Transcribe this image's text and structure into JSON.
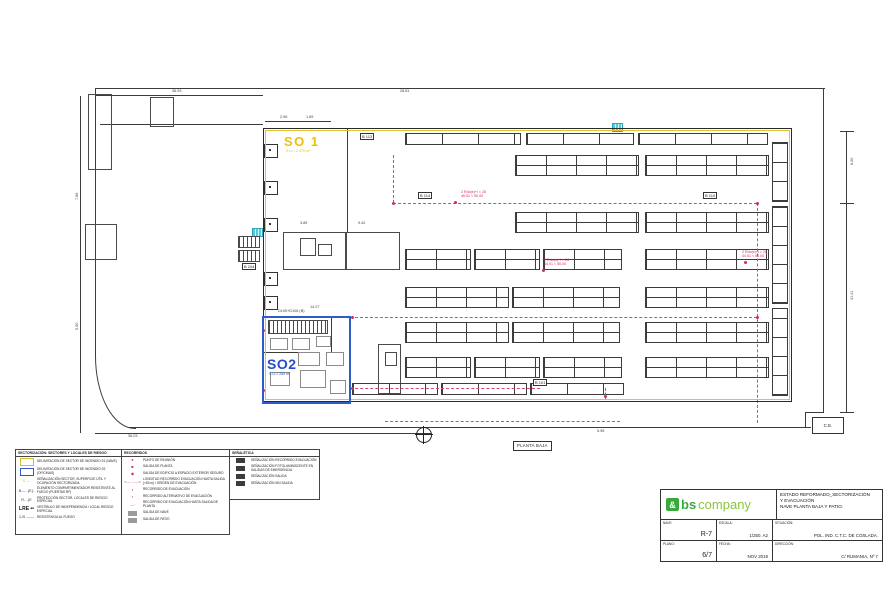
{
  "plan": {
    "sector1_label": "SO 1",
    "sector1_sub": "S.U.= 2.470 m²",
    "sector2_label": "SO2",
    "sector2_sub": "S.U.= 265 m²",
    "planta_label": "PLANTA BAJA",
    "ce_label": "C.E.",
    "walls": [
      [
        95,
        88,
        730,
        1
      ],
      [
        823,
        88,
        1,
        325
      ],
      [
        805,
        412,
        19,
        1
      ],
      [
        805,
        412,
        1,
        16
      ],
      [
        128,
        427,
        683,
        1
      ],
      [
        95,
        88,
        1,
        268
      ],
      [
        100,
        124,
        163,
        1
      ],
      [
        347,
        128,
        1,
        104
      ],
      [
        80,
        96,
        1,
        337
      ],
      [
        846,
        131,
        1,
        282
      ],
      [
        840,
        131,
        14,
        1
      ],
      [
        840,
        203,
        14,
        1
      ],
      [
        840,
        412,
        14,
        1
      ],
      [
        95,
        95,
        168,
        1
      ],
      [
        95,
        433,
        336,
        1
      ],
      [
        265,
        121,
        66,
        1
      ],
      [
        331,
        317,
        1,
        36
      ],
      [
        263,
        352,
        35,
        1
      ]
    ],
    "rooms": [
      [
        88,
        94,
        22,
        74
      ],
      [
        150,
        97,
        22,
        28
      ],
      [
        85,
        224,
        30,
        34
      ],
      [
        283,
        232,
        62,
        36
      ],
      [
        345,
        232,
        53,
        36
      ],
      [
        378,
        344,
        21,
        48
      ],
      [
        300,
        238,
        14,
        16
      ],
      [
        318,
        244,
        12,
        10
      ],
      [
        385,
        352,
        10,
        12
      ]
    ],
    "furniture": [
      [
        270,
        338,
        16,
        10
      ],
      [
        292,
        338,
        16,
        10
      ],
      [
        316,
        336,
        13,
        9
      ],
      [
        298,
        352,
        20,
        12
      ],
      [
        270,
        372,
        18,
        12
      ],
      [
        300,
        370,
        24,
        16
      ],
      [
        326,
        352,
        16,
        12
      ],
      [
        330,
        380,
        14,
        12
      ]
    ],
    "racks": {
      "double": {
        "h": 19,
        "rows": [
          {
            "y": 155,
            "seg": [
              [
                515,
                122
              ],
              [
                645,
                122
              ]
            ]
          },
          {
            "y": 212,
            "seg": [
              [
                515,
                122
              ],
              [
                645,
                122
              ]
            ]
          },
          {
            "y": 249,
            "seg": [
              [
                405,
                64
              ],
              [
                474,
                64
              ],
              [
                543,
                77
              ],
              [
                645,
                122
              ]
            ]
          },
          {
            "y": 287,
            "seg": [
              [
                405,
                102
              ],
              [
                512,
                106
              ],
              [
                645,
                122
              ]
            ]
          },
          {
            "y": 322,
            "seg": [
              [
                405,
                102
              ],
              [
                512,
                106
              ],
              [
                645,
                122
              ]
            ]
          },
          {
            "y": 357,
            "seg": [
              [
                405,
                64
              ],
              [
                474,
                64
              ],
              [
                543,
                77
              ],
              [
                645,
                122
              ]
            ]
          }
        ]
      },
      "single_h": {
        "h": 10,
        "rows": [
          {
            "y": 133,
            "seg": [
              [
                405,
                114
              ],
              [
                526,
                106
              ],
              [
                638,
                128
              ]
            ]
          },
          {
            "y": 383,
            "seg": [
              [
                352,
                84
              ],
              [
                441,
                84
              ],
              [
                530,
                92
              ]
            ]
          }
        ]
      },
      "single_v": {
        "w": 14,
        "cols": [
          {
            "x": 772,
            "seg": [
              [
                142,
                58
              ],
              [
                206,
                96
              ],
              [
                308,
                86
              ]
            ]
          }
        ]
      }
    },
    "routes": [
      {
        "d": "v",
        "x": 393,
        "y": 155,
        "l": 48
      },
      {
        "d": "h",
        "x": 393,
        "y": 203,
        "l": 364
      },
      {
        "d": "v",
        "x": 757,
        "y": 203,
        "l": 220
      },
      {
        "d": "h",
        "x": 350,
        "y": 317,
        "l": 407
      },
      {
        "d": "h",
        "x": 350,
        "y": 388,
        "l": 190
      },
      {
        "d": "v",
        "x": 605,
        "y": 388,
        "l": 12
      },
      {
        "d": "h",
        "x": 385,
        "y": 421,
        "l": 235
      }
    ],
    "red_dots": [
      [
        393,
        203
      ],
      [
        455,
        202
      ],
      [
        543,
        270
      ],
      [
        757,
        203
      ],
      [
        757,
        317
      ],
      [
        605,
        396
      ],
      [
        352,
        317
      ],
      [
        352,
        388
      ],
      [
        745,
        262
      ],
      [
        263,
        330
      ],
      [
        263,
        390
      ]
    ],
    "wall_boxes": [
      [
        264,
        144
      ],
      [
        264,
        181
      ],
      [
        264,
        218
      ],
      [
        264,
        272
      ],
      [
        264,
        296
      ]
    ],
    "cyan_grids": [
      [
        252,
        228
      ],
      [
        612,
        123
      ]
    ],
    "hatches": [
      [
        238,
        236,
        20,
        10
      ],
      [
        238,
        250,
        20,
        10
      ],
      [
        268,
        320,
        58,
        12
      ]
    ],
    "boxed_labels": [
      {
        "x": 418,
        "y": 192,
        "t": "B 114"
      },
      {
        "x": 703,
        "y": 192,
        "t": "B 110"
      },
      {
        "x": 360,
        "y": 133,
        "t": "B 113"
      },
      {
        "x": 533,
        "y": 379,
        "t": "B 101"
      },
      {
        "x": 242,
        "y": 263,
        "t": "B 104"
      }
    ],
    "red_notes": [
      {
        "x": 461,
        "y": 190,
        "lines": [
          "2 Rdo(s)+I = 28",
          "46,51 < 50,00"
        ]
      },
      {
        "x": 544,
        "y": 258,
        "lines": [
          "2 Rdo(s)+I = 28",
          "44,01 < 50,00"
        ]
      },
      {
        "x": 742,
        "y": 250,
        "lines": [
          "2 Rdo(s)+I = 28",
          "44,51 < 50,00"
        ]
      }
    ],
    "dims": [
      {
        "x": 172,
        "y": 89,
        "t": "36.93"
      },
      {
        "x": 280,
        "y": 115,
        "t": "2.96"
      },
      {
        "x": 306,
        "y": 115,
        "t": "1.89"
      },
      {
        "x": 400,
        "y": 89,
        "t": "28.81"
      },
      {
        "x": 128,
        "y": 434,
        "t": "36.03"
      },
      {
        "x": 597,
        "y": 429,
        "t": "5.98"
      },
      {
        "x": 850,
        "y": 165,
        "t": "6.00",
        "rot": 1
      },
      {
        "x": 850,
        "y": 300,
        "t": "41.41",
        "rot": 1
      },
      {
        "x": 75,
        "y": 200,
        "t": "7.86",
        "rot": 1
      },
      {
        "x": 75,
        "y": 330,
        "t": "5.90",
        "rot": 1
      },
      {
        "x": 300,
        "y": 221,
        "t": "3.85"
      },
      {
        "x": 358,
        "y": 221,
        "t": "9.42"
      },
      {
        "x": 310,
        "y": 305,
        "t": "14.27"
      },
      {
        "x": 278,
        "y": 309,
        "t": "D105+D106 (B)"
      }
    ]
  },
  "legends": [
    {
      "title": "SECTORIZACIÓN: SECTORES Y LOCALES DE RIESGO",
      "rows": [
        {
          "box": "yellow",
          "text": "DELIMITACIÓN DE SECTOR DE INCENDIO S1 (NAVE)"
        },
        {
          "box": "blue",
          "text": "DELIMITACIÓN DE SECTOR DE INCENDIO S2 (OFICINAS)"
        },
        {
          "glyph": "S —",
          "glyph_color": "#eec007",
          "text": "SEÑALIZACIÓN SECTOR, SUPERFICIE ÚTIL Y OCUPACIÓN SECTORIZADA"
        },
        {
          "glyph": "B— -(E)-",
          "glyph_color": "#444",
          "text": "ELEMENTO COMPARTIMENTADOR RESISTENTE AL FUEGO (PUERTAS RF)"
        },
        {
          "glyph": "R- -(E",
          "glyph_color": "#444",
          "text": "PROTECCIÓN SECTOR, LOCALES DE RIESGO ESPECIAL"
        },
        {
          "glyph": "LRE ••",
          "glyph_color": "#111",
          "bold": true,
          "text": "VESTÍBULO DE INDEPENDENCIA / LOCAL RIESGO ESPECIAL"
        },
        {
          "glyph": "1-B ——",
          "glyph_color": "#444",
          "text": "RESISTENCIA AL FUEGO"
        }
      ]
    },
    {
      "title": "RECORRIDOS",
      "rows": [
        {
          "glyph": "●",
          "glyph_color": "#cf2f5a",
          "text": "PUNTO DE REUNIÓN"
        },
        {
          "glyph": "■",
          "glyph_color": "#cf2f5a",
          "text": "SALIDA DE PLANTA"
        },
        {
          "glyph": "◆",
          "glyph_color": "#cf2f5a",
          "text": "SALIDA DE EDIFICIO A ESPACIO EXTERIOR SEGURO"
        },
        {
          "glyph": "×—→—×",
          "glyph_color": "#cf2f5a",
          "text": "LONGITUD RECORRIDO EVACUACIÓN HASTA SALIDA (<50 m) / ORIGEN DE EVACUACIÓN"
        },
        {
          "glyph": "◖",
          "glyph_color": "#cf2f5a",
          "text": "RECORRIDO DE EVACUACIÓN"
        },
        {
          "glyph": "▪",
          "glyph_color": "#cf2f5a",
          "text": "RECORRIDO ALTERNATIVO DE EVACUACIÓN"
        },
        {
          "glyph": "—·",
          "glyph_color": "#cf2f5a",
          "text": "RECORRIDO DE EVACUACIÓN HASTA SALIDA DE PLANTA"
        },
        {
          "box": "gray",
          "text": "SALIDA DE NAVE"
        },
        {
          "box": "gray",
          "text": "SALIDA DE PATIO"
        }
      ]
    },
    {
      "title": "SEÑALÉTICA",
      "rows": [
        {
          "box": "dark",
          "text": "SEÑALIZACIÓN RECORRIDO EVACUACIÓN"
        },
        {
          "box": "dark",
          "text": "SEÑALIZACIÓN FOTOLUMINISCENTE EN SALIDAS DE EMERGENCIA"
        },
        {
          "box": "dark",
          "text": "SEÑALIZACIÓN SALIDA"
        },
        {
          "box": "dark",
          "text": "SEÑALIZACIÓN SIN SALIDA"
        }
      ]
    }
  ],
  "title_block": {
    "logo": {
      "amp": "&",
      "bold": "bs",
      "light": "company"
    },
    "title_lines": [
      "ESTADO REFORMADO_SECTORIZACIÓN",
      "Y EVACUACIÓN",
      "NAVE PLANTA BAJA Y PATIO."
    ],
    "fields": [
      {
        "label": "NAVE:",
        "value": "R-7"
      },
      {
        "label": "ESCALA:",
        "value": "1/250. A2"
      },
      {
        "label": "SITUACIÓN:",
        "value": "POL. IND. C.T.C. DE COSLADA."
      },
      {
        "label": "PLANO:",
        "value": "6/7"
      },
      {
        "label": "FECHA:",
        "value": "NOV 2019"
      },
      {
        "label": "DIRECCIÓN:",
        "value": "C/ RUMANIA, Nº 7"
      }
    ]
  }
}
